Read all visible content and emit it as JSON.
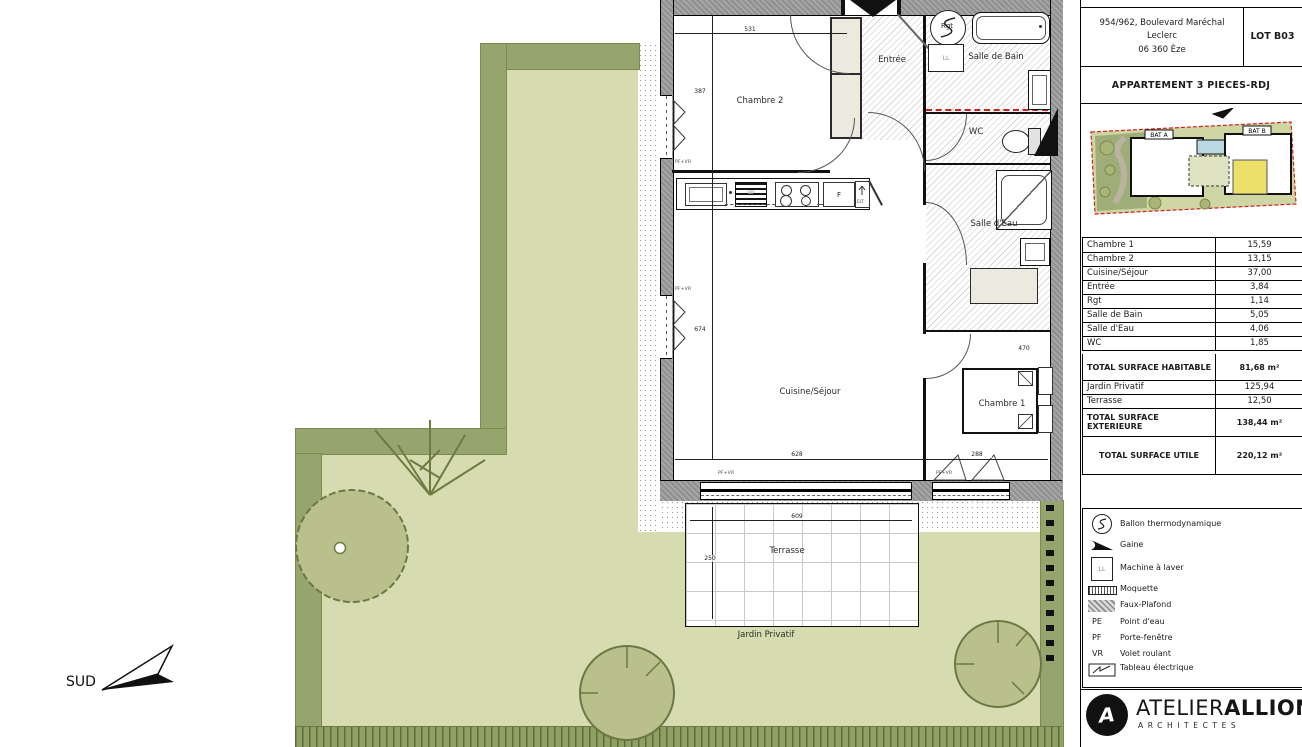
{
  "header": {
    "address_line1": "954/962, Boulevard Maréchal Leclerc",
    "address_line2": "06 360 Èze",
    "lot": "LOT B03",
    "title": "APPARTEMENT 3 PIECES-RDJ"
  },
  "site_plan": {
    "bat_a": "BAT A",
    "bat_b": "BAT B"
  },
  "surfaces": {
    "rows": [
      {
        "label": "Chambre 1",
        "value": "15,59"
      },
      {
        "label": "Chambre 2",
        "value": "13,15"
      },
      {
        "label": "Cuisine/Séjour",
        "value": "37,00"
      },
      {
        "label": "Entrée",
        "value": "3,84"
      },
      {
        "label": "Rgt",
        "value": "1,14"
      },
      {
        "label": "Salle de Bain",
        "value": "5,05"
      },
      {
        "label": "Salle d'Eau",
        "value": "4,06"
      },
      {
        "label": "WC",
        "value": "1,85"
      }
    ],
    "total_habitable": {
      "label": "TOTAL SURFACE  HABITABLE",
      "value": "81,68 m²"
    },
    "exterior_rows": [
      {
        "label": "Jardin Privatif",
        "value": "125,94"
      },
      {
        "label": "Terrasse",
        "value": "12,50"
      }
    ],
    "total_exterieure": {
      "label": "TOTAL SURFACE  EXTERIEURE",
      "value": "138,44 m²"
    },
    "total_utile": {
      "label": "TOTAL SURFACE  UTILE",
      "value": "220,12 m²"
    }
  },
  "legend": {
    "items": [
      {
        "label": "Ballon thermodynamique"
      },
      {
        "label": "Gaine"
      },
      {
        "label": "Machine à laver",
        "icon_text": "LL"
      },
      {
        "label": "Moquette"
      },
      {
        "label": "Faux-Plafond"
      },
      {
        "abbr": "PE",
        "label": "Point d'eau"
      },
      {
        "abbr": "PF",
        "label": "Porte-fenêtre"
      },
      {
        "abbr": "VR",
        "label": "Volet roulant"
      },
      {
        "label": "Tableau électrique"
      }
    ]
  },
  "logo": {
    "name_regular": "ATELIER",
    "name_bold": "ALLIONE",
    "subtitle": "ARCHITECTES",
    "mark_letter": "A"
  },
  "plan": {
    "rooms": {
      "chambre2": "Chambre 2",
      "entree": "Entrée",
      "salle_de_bain": "Salle de Bain",
      "wc": "WC",
      "salle_deau": "Salle d'Eau",
      "cuisine_sejour": "Cuisine/Séjour",
      "chambre1": "Chambre 1",
      "rgt": "Rgt",
      "terrasse": "Terrasse",
      "jardin": "Jardin Privatif"
    },
    "fixtures": {
      "ll": "LL",
      "lv": "LV",
      "f": "F",
      "elt": "ELT"
    },
    "dims": {
      "chambre2_w": "531",
      "chambre2_h": "387",
      "sejour_h": "674",
      "sejour_w": "628",
      "chambre1_w": "288",
      "chambre1_h": "470",
      "terrasse_w": "609",
      "terrasse_h": "250"
    },
    "window_label": "PF+VR",
    "compass": "SUD"
  },
  "colors": {
    "garden_light": "#d7dcb0",
    "hedge": "#96a56e",
    "tree": "#b9c08c",
    "wall_gray": "#9a9a9a",
    "accent_red": "#cf1f1f",
    "unit_highlight": "#ede06a",
    "pool_blue": "#bcd9e3"
  }
}
